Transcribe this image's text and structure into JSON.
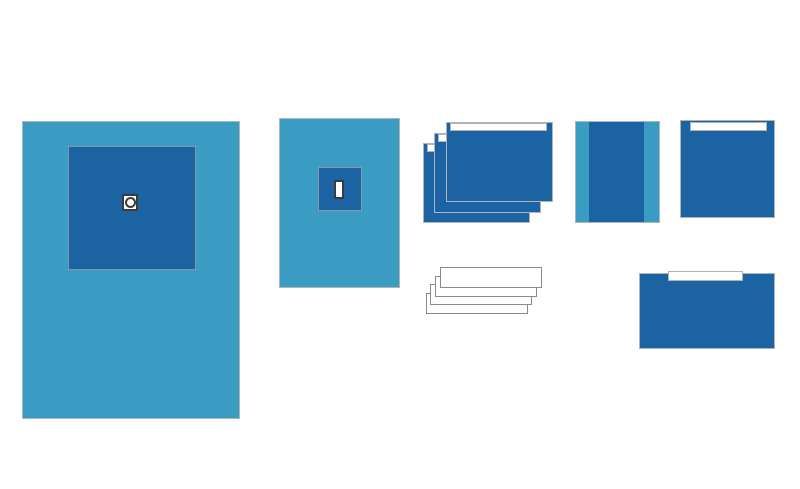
{
  "scene": {
    "title": "Surgical drape pack contents illustration",
    "background": "#FFFFFF",
    "width": 800,
    "height": 489
  },
  "colors": {
    "light_blue": "#3B9CC3",
    "dark_blue": "#1C63A4",
    "border_gray": "#AEB4B8",
    "panel_border": "#8A97A3",
    "towel_gray": "#8A8A8A",
    "outline_dark": "#3B3B3B",
    "white": "#FFFFFF"
  },
  "items": [
    {
      "id": "large-fenestrated-drape",
      "kind": "drape",
      "layers": 1,
      "features": [
        "reinforcement-panel",
        "round-fenestration"
      ]
    },
    {
      "id": "small-fenestrated-drape",
      "kind": "drape",
      "layers": 1,
      "features": [
        "reinforcement-panel",
        "rectangular-slot"
      ]
    },
    {
      "id": "adhesive-side-drape-stack",
      "kind": "drape-stack",
      "layers": 3,
      "features": [
        "adhesive-strip"
      ]
    },
    {
      "id": "banded-drape",
      "kind": "drape",
      "layers": 1,
      "features": [
        "light-side-bands",
        "dark-center-panel"
      ]
    },
    {
      "id": "adhesive-drape-square",
      "kind": "drape",
      "layers": 1,
      "features": [
        "adhesive-strip"
      ]
    },
    {
      "id": "hand-towel-stack",
      "kind": "towel-stack",
      "layers": 4,
      "features": []
    },
    {
      "id": "adhesive-drape-wide",
      "kind": "drape",
      "layers": 1,
      "features": [
        "adhesive-strip"
      ]
    }
  ]
}
